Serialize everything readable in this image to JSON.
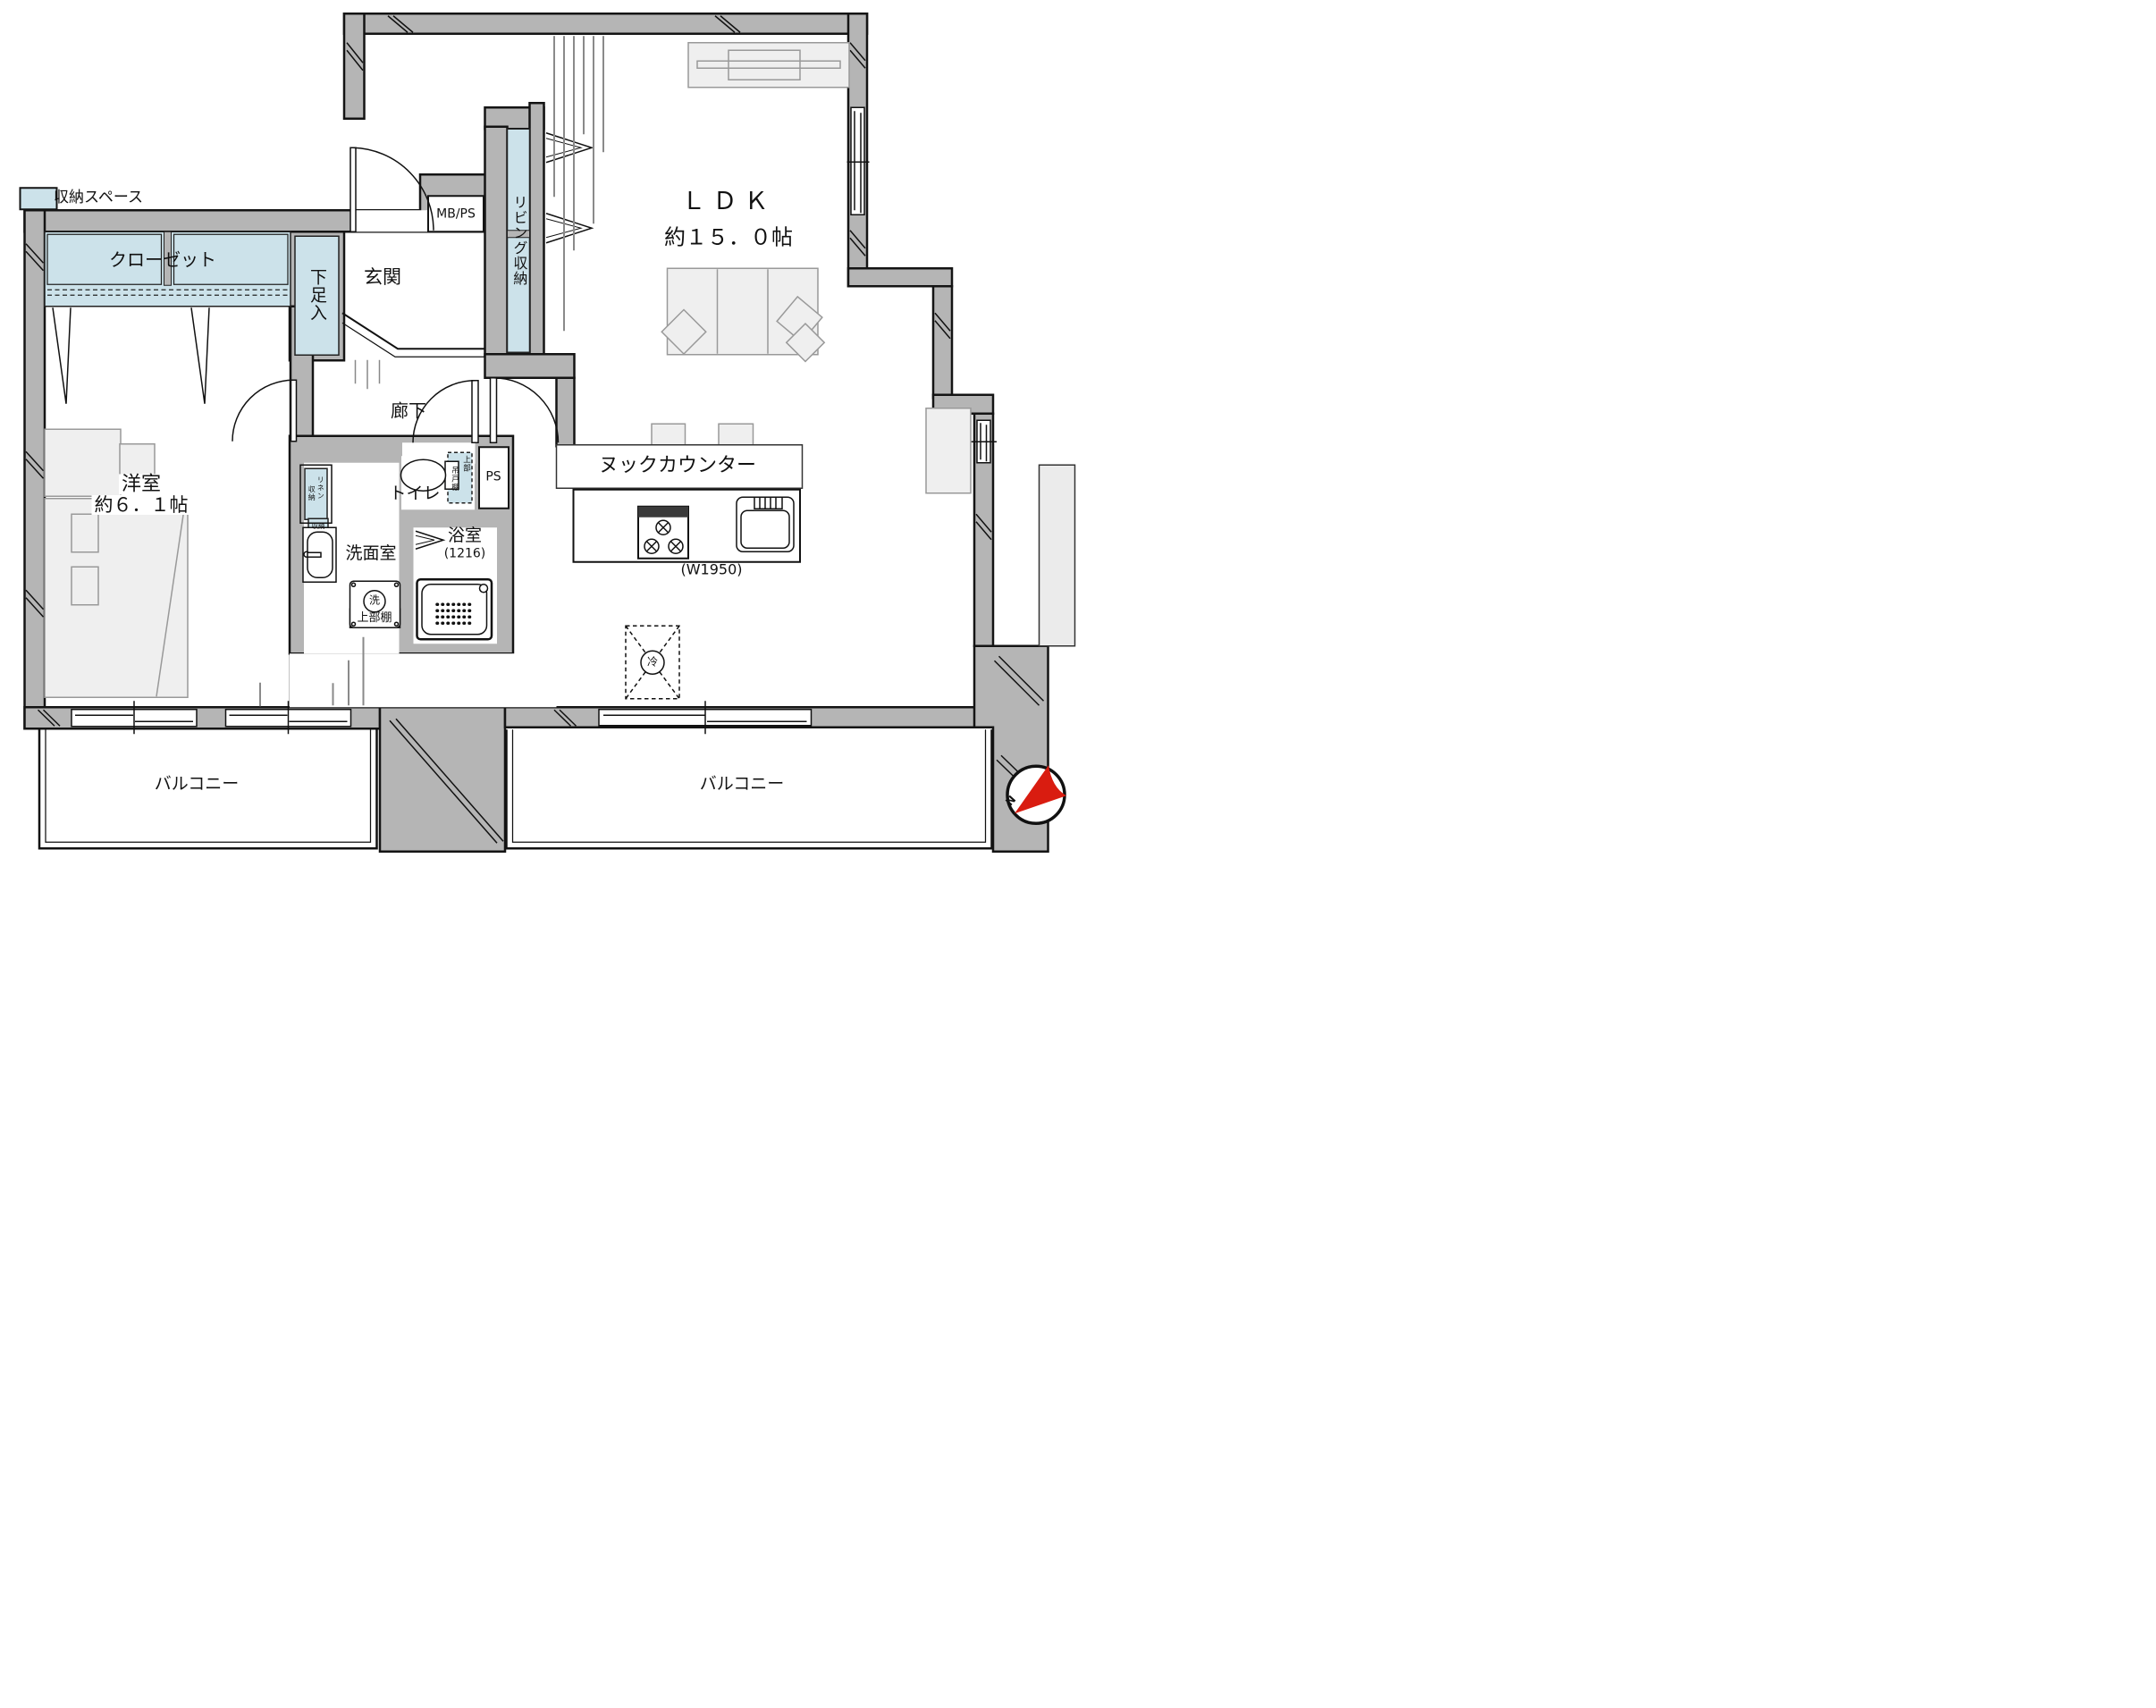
{
  "legend": {
    "swatch_label": "収納スペース"
  },
  "rooms": {
    "ldk_name": "ＬＤＫ",
    "ldk_size": "約１５．０帖",
    "western_name": "洋室",
    "western_size": "約６．１帖",
    "entrance": "玄関",
    "hallway": "廊下",
    "toilet": "トイレ",
    "washroom": "洗面室",
    "bath": "浴室",
    "bath_size": "(1216)",
    "balcony_left": "バルコニー",
    "balcony_right": "バルコニー"
  },
  "storage": {
    "closet": "クローゼット",
    "shoe_cabinet": "下足入",
    "living_storage": "リビング収納",
    "linen_col_right": "リネン",
    "linen_col_left": "収納",
    "small_storage": "収納",
    "upper_shelf": "上部棚",
    "hanging_col_right": "上部",
    "hanging_col_left": "吊戸棚"
  },
  "kitchen": {
    "nook_counter": "ヌックカウンター",
    "counter_width": "(W1950)",
    "washer_mark": "洗",
    "fridge_mark": "冷"
  },
  "service": {
    "mbps": "MB/PS",
    "ps": "PS"
  },
  "compass": {
    "north": "N"
  },
  "colors": {
    "wall": "#b5b5b5",
    "storage_fill": "#cce2ea",
    "furniture_fill": "#efefef",
    "compass_red": "#d91c10"
  }
}
